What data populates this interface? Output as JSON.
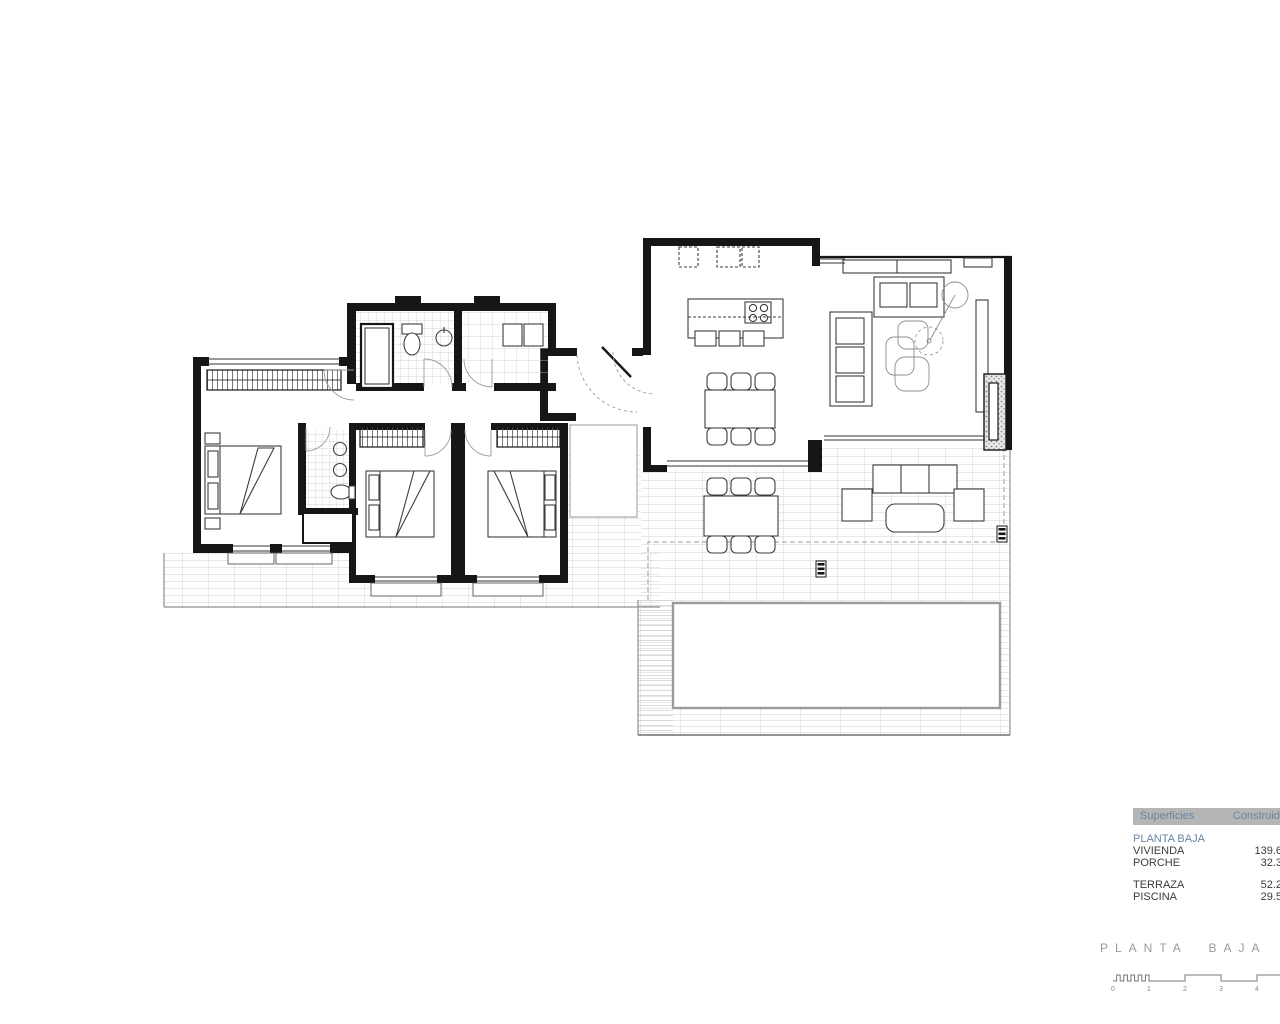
{
  "summary_table": {
    "header": {
      "col1": "Superficies",
      "col2": "Construida"
    },
    "section_label": "PLANTA BAJA",
    "groups": [
      {
        "rows": [
          {
            "label": "VIVIENDA",
            "value": "139.6"
          },
          {
            "label": "PORCHE",
            "value": "32.3"
          }
        ]
      },
      {
        "rows": [
          {
            "label": "TERRAZA",
            "value": "52.2"
          },
          {
            "label": "PISCINA",
            "value": "29.5"
          }
        ]
      }
    ],
    "colors": {
      "header_bg": "#b5b5b5",
      "header_text": "#6a85a1",
      "section_text": "#6a85a1",
      "row_text": "#3c3c3c"
    }
  },
  "title_block": {
    "plan_title": "PLANTA BAJA",
    "scale_ticks": [
      "0",
      "1",
      "2",
      "3",
      "4"
    ]
  },
  "floor_plan": {
    "colors": {
      "walls": "#161616",
      "furniture_lines": "#3d3d3d",
      "tile_grid": "#c7c7c7",
      "pool_border": "#9b9b9b",
      "dashed_boundary": "#9a9a9a",
      "title_text": "#9a9a9a"
    }
  }
}
